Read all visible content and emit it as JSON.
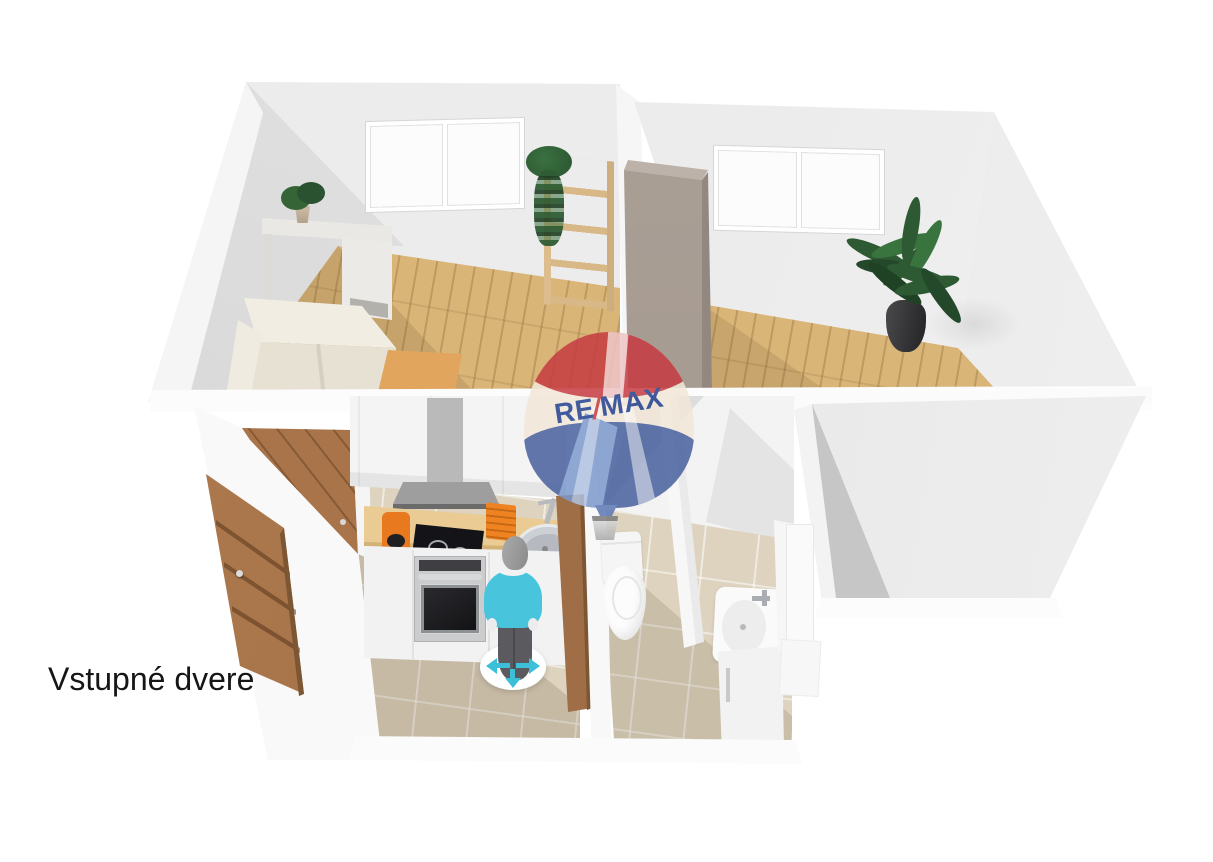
{
  "caption": {
    "text": "Vstupné dvere"
  },
  "watermark": {
    "re": "RE",
    "slash": "/",
    "max": "MAX",
    "full": "RE/MAX"
  },
  "colors": {
    "background": "#ffffff",
    "wall_light": "#ececec",
    "wall_shadow": "#d3d3d3",
    "wood_floor": "#d9b578",
    "tile_floor": "#ddd3bf",
    "gray_floor": "#e9e9e9",
    "door_wood": "#a9744a",
    "wardrobe_taupe": "#a89d95",
    "counter_wood": "#e9cb93",
    "appliance_orange": "#e8791f",
    "cooktop_black": "#141418",
    "plant_green": "#2d5a32",
    "sofa_cream": "#e7e1d4",
    "coffee_table": "#e2a55e",
    "balloon_red": "#c63c42",
    "balloon_blue": "#49619f",
    "balloon_light_blue": "#7d99cc",
    "balloon_cream": "#f2e8d9",
    "balloon_text_blue": "#23418f",
    "figure_shirt_cyan": "#49c4dd",
    "figure_pants_gray": "#5a5a5f",
    "move_arrow_cyan": "#3cc0da",
    "basket_gray": "#c9c9c9"
  },
  "objects": [
    "living-room",
    "bedroom",
    "kitchen",
    "entrance-hall",
    "bathroom",
    "empty-room",
    "sofa",
    "coffee-table",
    "console-table",
    "potted-plant",
    "ladder-shelf",
    "hanging-plant",
    "window",
    "wardrobe",
    "floor-plant",
    "entrance-door",
    "open-door",
    "bathroom-door",
    "upper-cabinets",
    "range-hood",
    "countertop",
    "cooktop",
    "oven",
    "kitchen-sink",
    "coffee-maker",
    "dish-rack",
    "toilet",
    "vanity-sink",
    "human-figure",
    "move-widget",
    "remax-balloon-watermark"
  ]
}
